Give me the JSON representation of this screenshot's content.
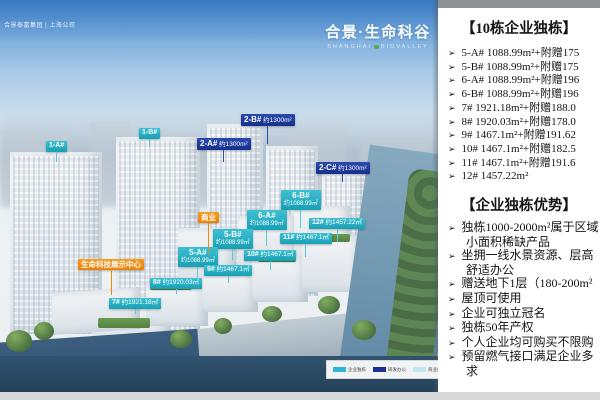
{
  "header": {
    "brand_left": "合景泰富集团 | 上海公司",
    "logo_title": "合景·生命科谷",
    "logo_subtitle_left": "SHANGHAI",
    "logo_subtitle_right": "BIOVALLEY"
  },
  "panel": {
    "title_buildings": "【10栋企业独栋】",
    "bullet": "➢",
    "buildings": [
      "5-A#  1088.99m²+附赠175",
      "5-B#  1088.99m²+附赠175",
      "6-A#  1088.99m²+附赠196",
      "6-B#  1088.99m²+附赠196",
      "7#  1921.18m²+附赠188.0",
      "8#  1920.03m²+附赠178.0",
      "9#  1467.1m²+附赠191.62",
      "10#  1467.1m²+附赠182.5",
      "11#  1467.1m²+附赠191.6",
      "12#  1457.22m²"
    ],
    "title_advantages": "【企业独栋优势】",
    "advantages": [
      {
        "lines": [
          "独栋1000-2000m²属于区域",
          "小面积稀缺产品"
        ]
      },
      {
        "lines": [
          "坐拥一线水景资源、层高",
          "舒适办公"
        ]
      },
      {
        "lines": [
          "赠送地下1层（180-200m²"
        ]
      },
      {
        "lines": [
          "屋顶可使用"
        ]
      },
      {
        "lines": [
          "企业可独立冠名"
        ]
      },
      {
        "lines": [
          "独栋50年产权"
        ]
      },
      {
        "lines": [
          "个人企业均可购买不限购"
        ]
      },
      {
        "lines": [
          "预留燃气接口满足企业多",
          "求"
        ]
      }
    ]
  },
  "render": {
    "colors": {
      "teal": "#1fadc2",
      "navy": "#1d3a96",
      "orange": "#f08905"
    },
    "tags": [
      {
        "type": "teal",
        "label": "1-A#",
        "x": 46,
        "y": 141,
        "lead": 10
      },
      {
        "type": "teal",
        "label": "1-B#",
        "x": 139,
        "y": 128,
        "lead": 8
      },
      {
        "type": "navy",
        "label": "2-A#",
        "area": "约1300m²",
        "x": 197,
        "y": 138,
        "lead": 12
      },
      {
        "type": "navy",
        "label": "2-B#",
        "area": "约1300m²",
        "x": 241,
        "y": 114,
        "lead": 18
      },
      {
        "type": "navy",
        "label": "2-C#",
        "area": "约1300m²",
        "x": 316,
        "y": 162,
        "lead": 8
      },
      {
        "type": "teal",
        "two": true,
        "label": "6-B#",
        "area": "约1088.99㎡",
        "x": 281,
        "y": 190,
        "lead": 18
      },
      {
        "type": "teal",
        "two": true,
        "label": "6-A#",
        "area": "约1088.99㎡",
        "x": 247,
        "y": 210,
        "lead": 16
      },
      {
        "type": "teal",
        "two": true,
        "label": "5-B#",
        "area": "约1088.99㎡",
        "x": 213,
        "y": 229,
        "lead": 11
      },
      {
        "type": "teal",
        "two": true,
        "label": "5-A#",
        "area": "约1088.99㎡",
        "x": 178,
        "y": 247,
        "lead": 11
      },
      {
        "type": "teal",
        "label": "12#",
        "area": "约1457.22㎡",
        "x": 309,
        "y": 218,
        "lead": 13
      },
      {
        "type": "teal",
        "label": "11#",
        "area": "约1467.1㎡",
        "x": 280,
        "y": 233,
        "lead": 13
      },
      {
        "type": "teal",
        "label": "10#",
        "area": "约1467.1㎡",
        "x": 244,
        "y": 250,
        "lead": 9
      },
      {
        "type": "teal",
        "label": "9#",
        "area": "约1467.1㎡",
        "x": 204,
        "y": 265,
        "lead": 7
      },
      {
        "type": "teal",
        "label": "8#",
        "area": "约1920.03㎡",
        "x": 150,
        "y": 278,
        "lead": 5
      },
      {
        "type": "teal",
        "label": "7#",
        "area": "约1921.18㎡",
        "x": 109,
        "y": 298,
        "lead": 5
      },
      {
        "type": "orange",
        "label": "商业",
        "x": 198,
        "y": 212,
        "lead": 30
      },
      {
        "type": "orange",
        "label": "生命科技展示中心",
        "x": 78,
        "y": 259,
        "lead": 25
      }
    ],
    "legend": [
      {
        "color": "#2fb5d8",
        "label": "企业独栋"
      },
      {
        "color": "#1e2f8f",
        "label": "研发办公"
      },
      {
        "color": "#bfe6ee",
        "label": "商业配套"
      }
    ]
  }
}
